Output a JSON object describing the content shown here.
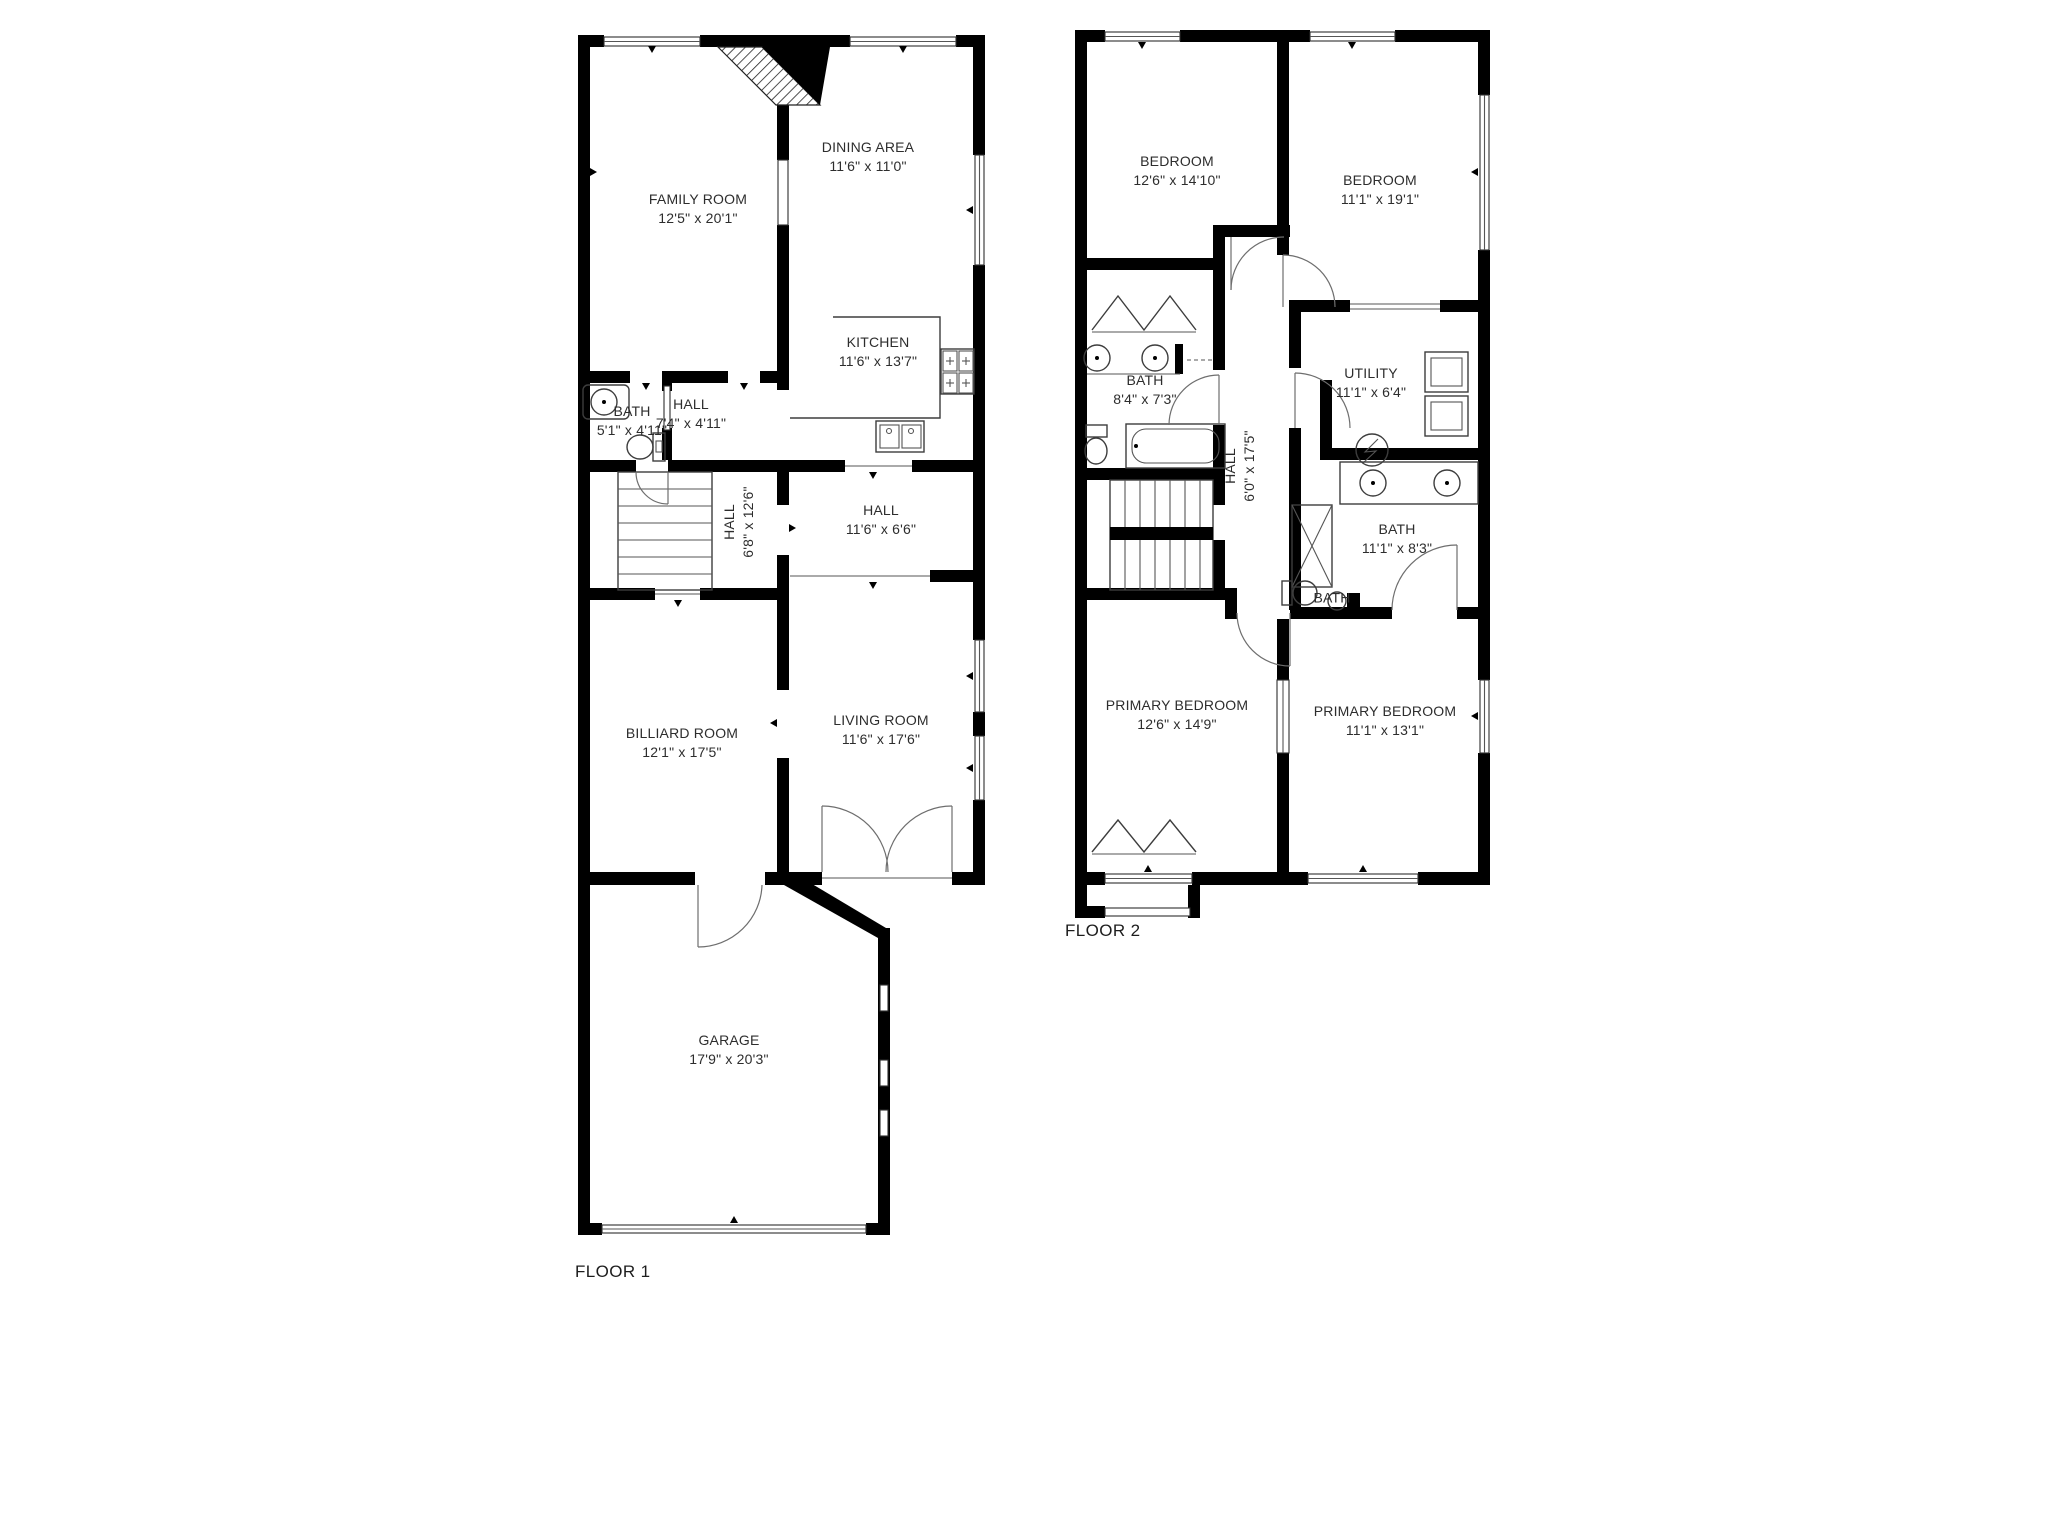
{
  "document": {
    "background": "#ffffff",
    "wall_color": "#000000",
    "fixture_line_color": "#3d3d3d"
  },
  "floor1": {
    "title": "FLOOR 1",
    "rooms": {
      "family_room": {
        "name": "FAMILY ROOM",
        "dims": "12'5\" x 20'1\""
      },
      "dining_area": {
        "name": "DINING AREA",
        "dims": "11'6\" x 11'0\""
      },
      "kitchen": {
        "name": "KITCHEN",
        "dims": "11'6\" x 13'7\""
      },
      "bath": {
        "name": "BATH",
        "dims": "5'1\" x 4'11\""
      },
      "hall_front": {
        "name": "HALL",
        "dims": "7'4\" x 4'11\""
      },
      "hall_stairs": {
        "name": "HALL",
        "dims": "6'8\" x 12'6\""
      },
      "hall_center": {
        "name": "HALL",
        "dims": "11'6\" x 6'6\""
      },
      "billiard_room": {
        "name": "BILLIARD ROOM",
        "dims": "12'1\" x 17'5\""
      },
      "living_room": {
        "name": "LIVING ROOM",
        "dims": "11'6\" x 17'6\""
      },
      "garage": {
        "name": "GARAGE",
        "dims": "17'9\" x 20'3\""
      }
    }
  },
  "floor2": {
    "title": "FLOOR 2",
    "rooms": {
      "bedroom_left": {
        "name": "BEDROOM",
        "dims": "12'6\" x 14'10\""
      },
      "bedroom_right": {
        "name": "BEDROOM",
        "dims": "11'1\" x 19'1\""
      },
      "bath_top": {
        "name": "BATH",
        "dims": "8'4\" x 7'3\""
      },
      "utility": {
        "name": "UTILITY",
        "dims": "11'1\" x 6'4\""
      },
      "hall": {
        "name": "HALL",
        "dims": "6'0\" x 17'5\""
      },
      "bath_middle": {
        "name": "BATH",
        "dims": "11'1\" x 8'3\""
      },
      "bath_small": {
        "name": "BATH",
        "dims": ""
      },
      "primary_bedroom_left": {
        "name": "PRIMARY BEDROOM",
        "dims": "12'6\" x 14'9\""
      },
      "primary_bedroom_right": {
        "name": "PRIMARY BEDROOM",
        "dims": "11'1\" x 13'1\""
      }
    }
  }
}
